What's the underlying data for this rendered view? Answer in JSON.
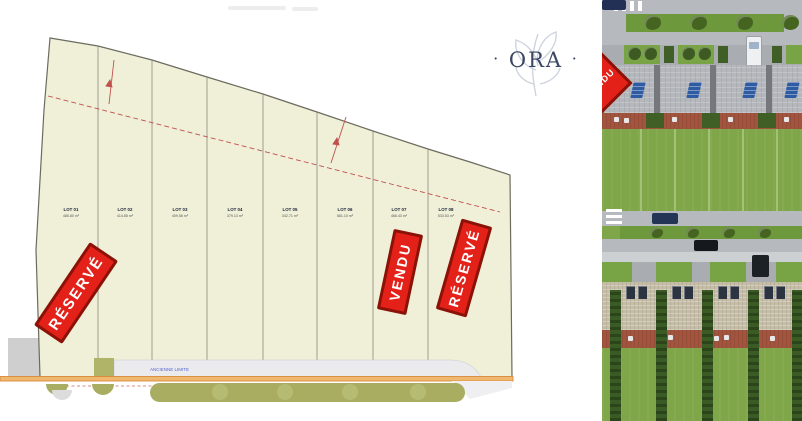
{
  "logo": {
    "left_dot": "·",
    "text": "ORA",
    "right_dot": "·"
  },
  "plan": {
    "lots": [
      {
        "label": "LOT 01",
        "area": "485.80 m²"
      },
      {
        "label": "LOT 02",
        "area": "414.85 m²"
      },
      {
        "label": "LOT 03",
        "area": "409.56 m²"
      },
      {
        "label": "LOT 04",
        "area": "379.13 m²"
      },
      {
        "label": "LOT 05",
        "area": "342.71 m²"
      },
      {
        "label": "LOT 06",
        "area": "581.10 m²"
      },
      {
        "label": "LOT 07",
        "area": "466.43 m²"
      },
      {
        "label": "LOT 08",
        "area": "533.53 m²"
      }
    ],
    "road_label": "ANCIENNE LIMITE",
    "banners": [
      {
        "lot": "LOT 01",
        "text": "RÉSERVÉ"
      },
      {
        "lot": "LOT 07",
        "text": "VENDU"
      },
      {
        "lot": "LOT 08",
        "text": "RÉSERVÉ"
      }
    ]
  },
  "render": {
    "banner_corner_text": "VENDU"
  },
  "colors": {
    "banner_red": "#e32119",
    "banner_border": "#8c1208",
    "plan_fill": "#f0f0d9",
    "plan_stroke": "#6b6b5e",
    "logo_navy": "#3a4763",
    "orange_line": "#d98a3a",
    "hedge_olive": "#a9ad62",
    "grass": "#7fa648"
  }
}
